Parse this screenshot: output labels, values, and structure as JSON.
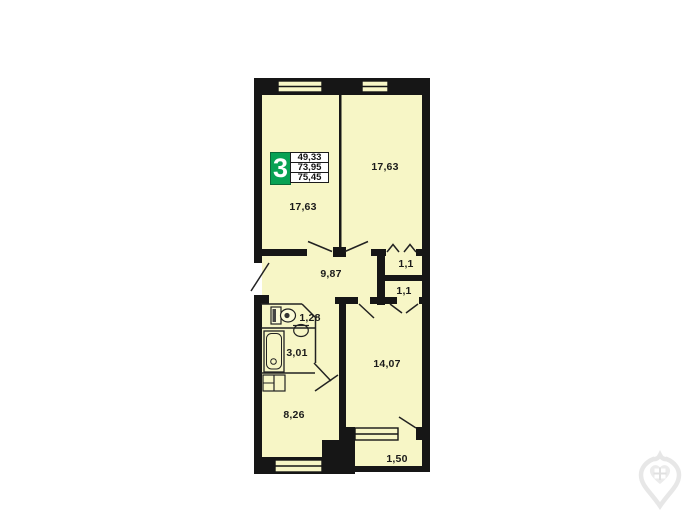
{
  "badge": {
    "rooms_count": "3",
    "area_values": [
      "49,33",
      "73,95",
      "75,45"
    ]
  },
  "rooms": [
    {
      "name": "room-1",
      "area": "17,63"
    },
    {
      "name": "room-2",
      "area": "17,63"
    },
    {
      "name": "hallway",
      "area": "9,87"
    },
    {
      "name": "closet-1",
      "area": "1,1"
    },
    {
      "name": "closet-2",
      "area": "1,1"
    },
    {
      "name": "wc",
      "area": "1,28"
    },
    {
      "name": "bathroom",
      "area": "3,01"
    },
    {
      "name": "room-3",
      "area": "14,07"
    },
    {
      "name": "kitchen",
      "area": "8,26"
    },
    {
      "name": "balcony",
      "area": "1,50"
    }
  ],
  "icons": {
    "watermark": "location-pin-house",
    "fixtures": [
      "toilet",
      "bathtub",
      "sink",
      "stove"
    ]
  },
  "colors": {
    "floor": "#f7f6c6",
    "wall": "#161616",
    "badge_green": "#08a254",
    "line": "#222222",
    "watermark_gray": "#e7e7e7"
  }
}
